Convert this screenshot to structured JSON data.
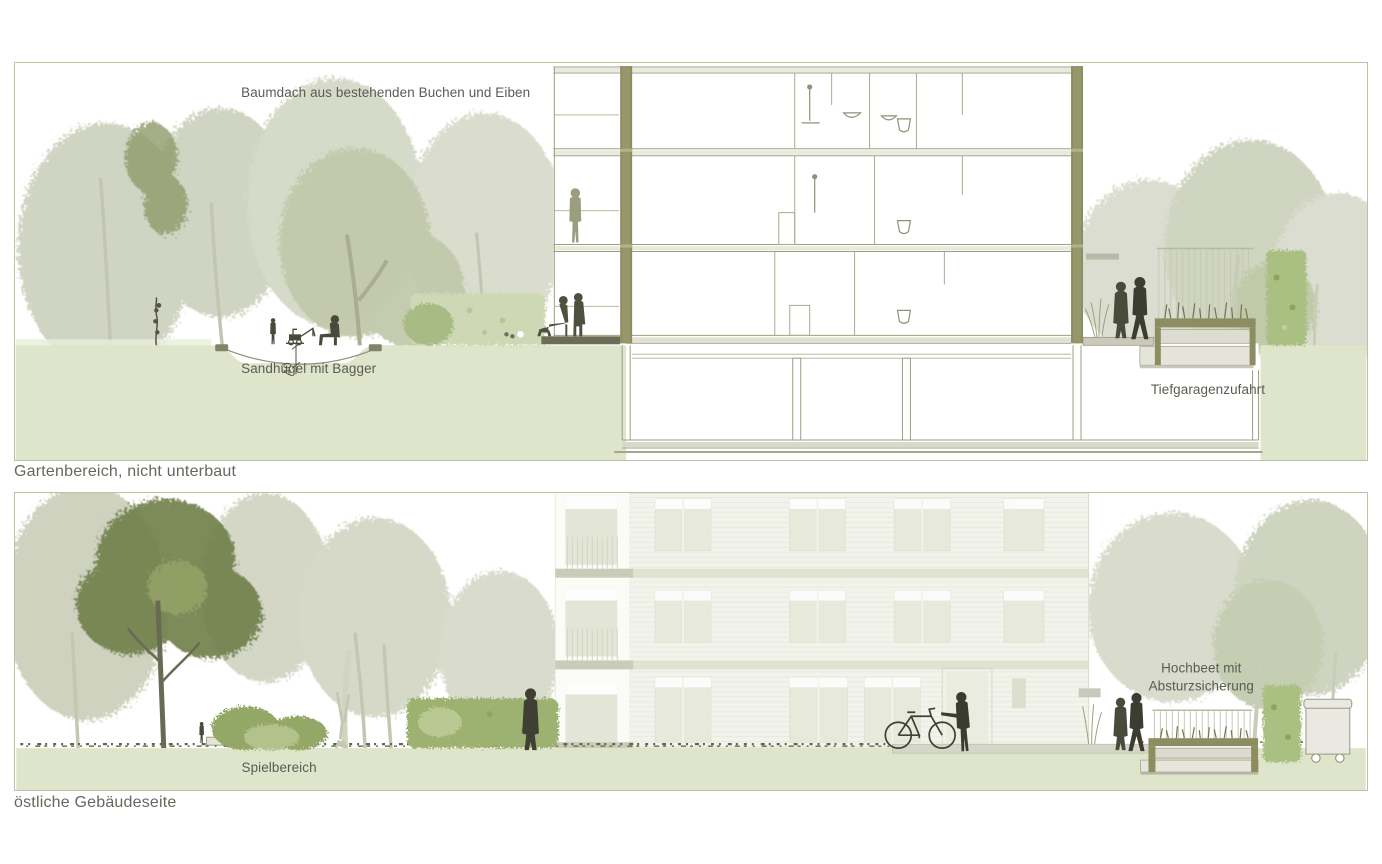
{
  "sheet": {
    "type": "landscape-architecture sections",
    "language": "de"
  },
  "panel1": {
    "caption": "Gartenbereich, nicht unterbaut",
    "labels": {
      "canopy": "Baumdach aus bestehenden Buchen und Eiben",
      "sand": "Sandhügel mit Bagger",
      "dimension": "40",
      "garage": "Tiefgaragenzufahrt"
    }
  },
  "panel2": {
    "caption": "östliche Gebäudeseite",
    "labels": {
      "play": "Spielbereich",
      "bed_line1": "Hochbeet mit",
      "bed_line2": "Absturzsicherung"
    }
  },
  "colors": {
    "ground_green": "#dee5cb",
    "foliage_faint": "#cdd1bd",
    "foliage_mid": "#c2c9ab",
    "foliage_dark": "#72814e",
    "hedge_green": "#a9bb84",
    "figure_dark": "#3f3f33",
    "figure_light": "#9c9c7e",
    "section_wall_olive": "#8d8d62",
    "drawing_line": "#9ba080",
    "label_text": "#5b5b53",
    "panel_border": "#bcc2a4"
  }
}
